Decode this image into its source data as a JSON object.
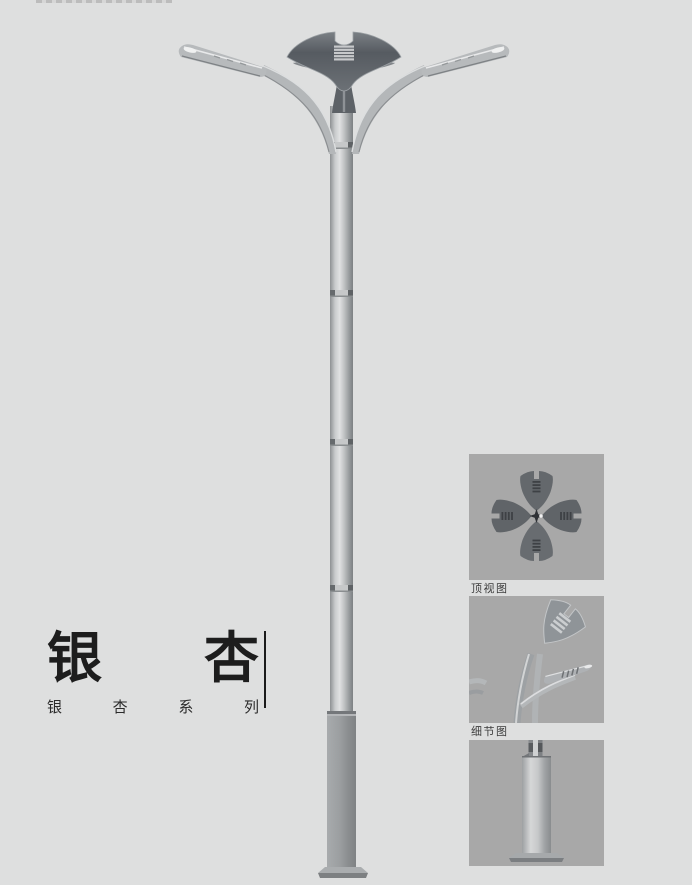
{
  "page": {
    "background": "#dedfdf",
    "width": 692,
    "height": 885,
    "description": "Street lamp product catalog page, ginkgo-leaf double-arm pole"
  },
  "title": {
    "large": [
      "银",
      "杏"
    ],
    "series": [
      "银",
      "杏",
      "系",
      "列"
    ]
  },
  "thumbnails": [
    {
      "caption": "顶视图"
    },
    {
      "caption": "细节图"
    },
    {
      "caption": ""
    }
  ],
  "colors": {
    "page_bg": "#dedfdf",
    "panel_bg": "#a8a8a8",
    "leaf_dark": "#565b61",
    "leaf_edge": "#9ba0a4",
    "metal_light": "#c9cbcc",
    "metal_mid": "#b4b7b9",
    "metal_shadow": "#85888b",
    "base_gray": "#95989a",
    "title_text": "#1d1d1d",
    "caption_text": "#3c3c3c",
    "divider": "#1b1b1b"
  }
}
